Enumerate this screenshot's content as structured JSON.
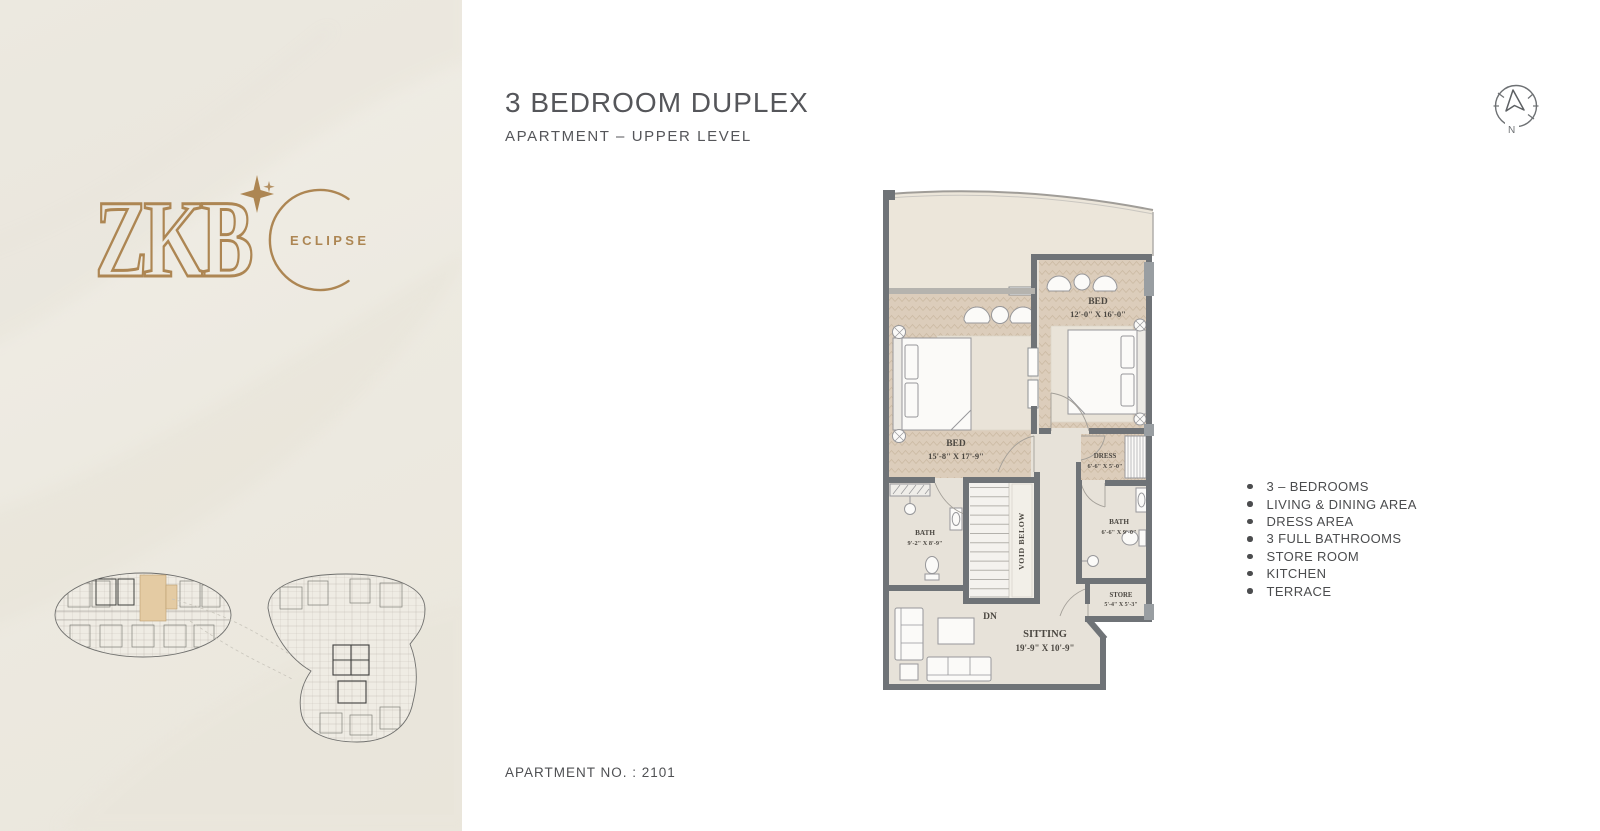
{
  "brand": {
    "name": "ZKB",
    "wordmark": "ECLIPSE",
    "accent_color": "#ad8653"
  },
  "header": {
    "title": "3 BEDROOM DUPLEX",
    "subtitle": "APARTMENT – UPPER LEVEL"
  },
  "compass": {
    "north_label": "N"
  },
  "plan": {
    "bed1_name": "BED",
    "bed1_dims": "15'-8\" X 17'-9\"",
    "bed2_name": "BED",
    "bed2_dims": "12'-0\" X 16'-0\"",
    "dress_name": "DRESS",
    "dress_dims": "6'-6\" X 5'-0\"",
    "bath1_name": "BATH",
    "bath1_dims": "9'-2\" X 8'-9\"",
    "bath2_name": "BATH",
    "bath2_dims": "6'-6\" X 9'-0\"",
    "store_name": "STORE",
    "store_dims": "5'-4\" X 5'-3\"",
    "sitting_name": "SITTING",
    "sitting_dims": "19'-9\" X 10'-9\"",
    "void_label": "VOID BELOW",
    "stairs_label": "DN",
    "colors": {
      "wall": "#6f7377",
      "wood_floor": "#dccdbb",
      "plain_floor": "#e7e2d9",
      "terrace_floor": "#ece6da"
    }
  },
  "features": {
    "items": [
      "3 – BEDROOMS",
      "LIVING & DINING AREA",
      "DRESS AREA",
      "3 FULL BATHROOMS",
      "STORE ROOM",
      "KITCHEN",
      "TERRACE"
    ]
  },
  "footer": {
    "apartment_no": "APARTMENT NO. : 2101"
  }
}
